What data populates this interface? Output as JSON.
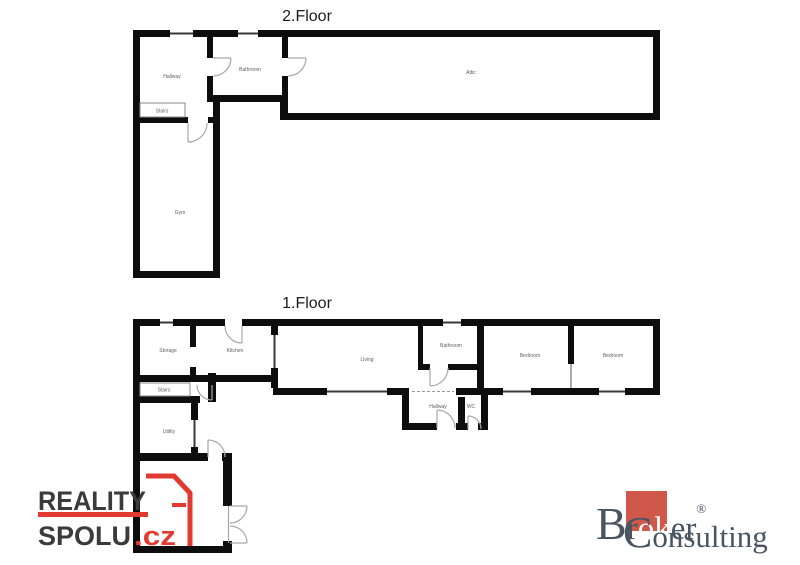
{
  "floor2": {
    "title": "2.Floor",
    "rooms": [
      {
        "label": "Hallway"
      },
      {
        "label": "Bathroom"
      },
      {
        "label": "Attic"
      },
      {
        "label": "Stairs"
      },
      {
        "label": "Gym"
      }
    ]
  },
  "floor1": {
    "title": "1.Floor",
    "rooms": [
      {
        "label": "Storage"
      },
      {
        "label": "Kitchen"
      },
      {
        "label": "Living"
      },
      {
        "label": "Bathroom"
      },
      {
        "label": "Bedroom"
      },
      {
        "label": "Bedroom"
      },
      {
        "label": "Stairs"
      },
      {
        "label": "Hallway"
      },
      {
        "label": "WC"
      },
      {
        "label": "Utility"
      }
    ]
  },
  "branding": {
    "reality_spolu": {
      "word1": "REALITY",
      "word2": "SPOLU",
      "tld": ".cz",
      "accent_red": "#e23a30",
      "text_gray": "#3b3b3b"
    },
    "broker_consulting": {
      "word1_parts": [
        "B",
        "r",
        "ok",
        "er"
      ],
      "registered": "®",
      "word2_parts": [
        "C",
        "onsulting"
      ],
      "square_red": "#cf584a",
      "text_slate": "#4a5562"
    }
  }
}
